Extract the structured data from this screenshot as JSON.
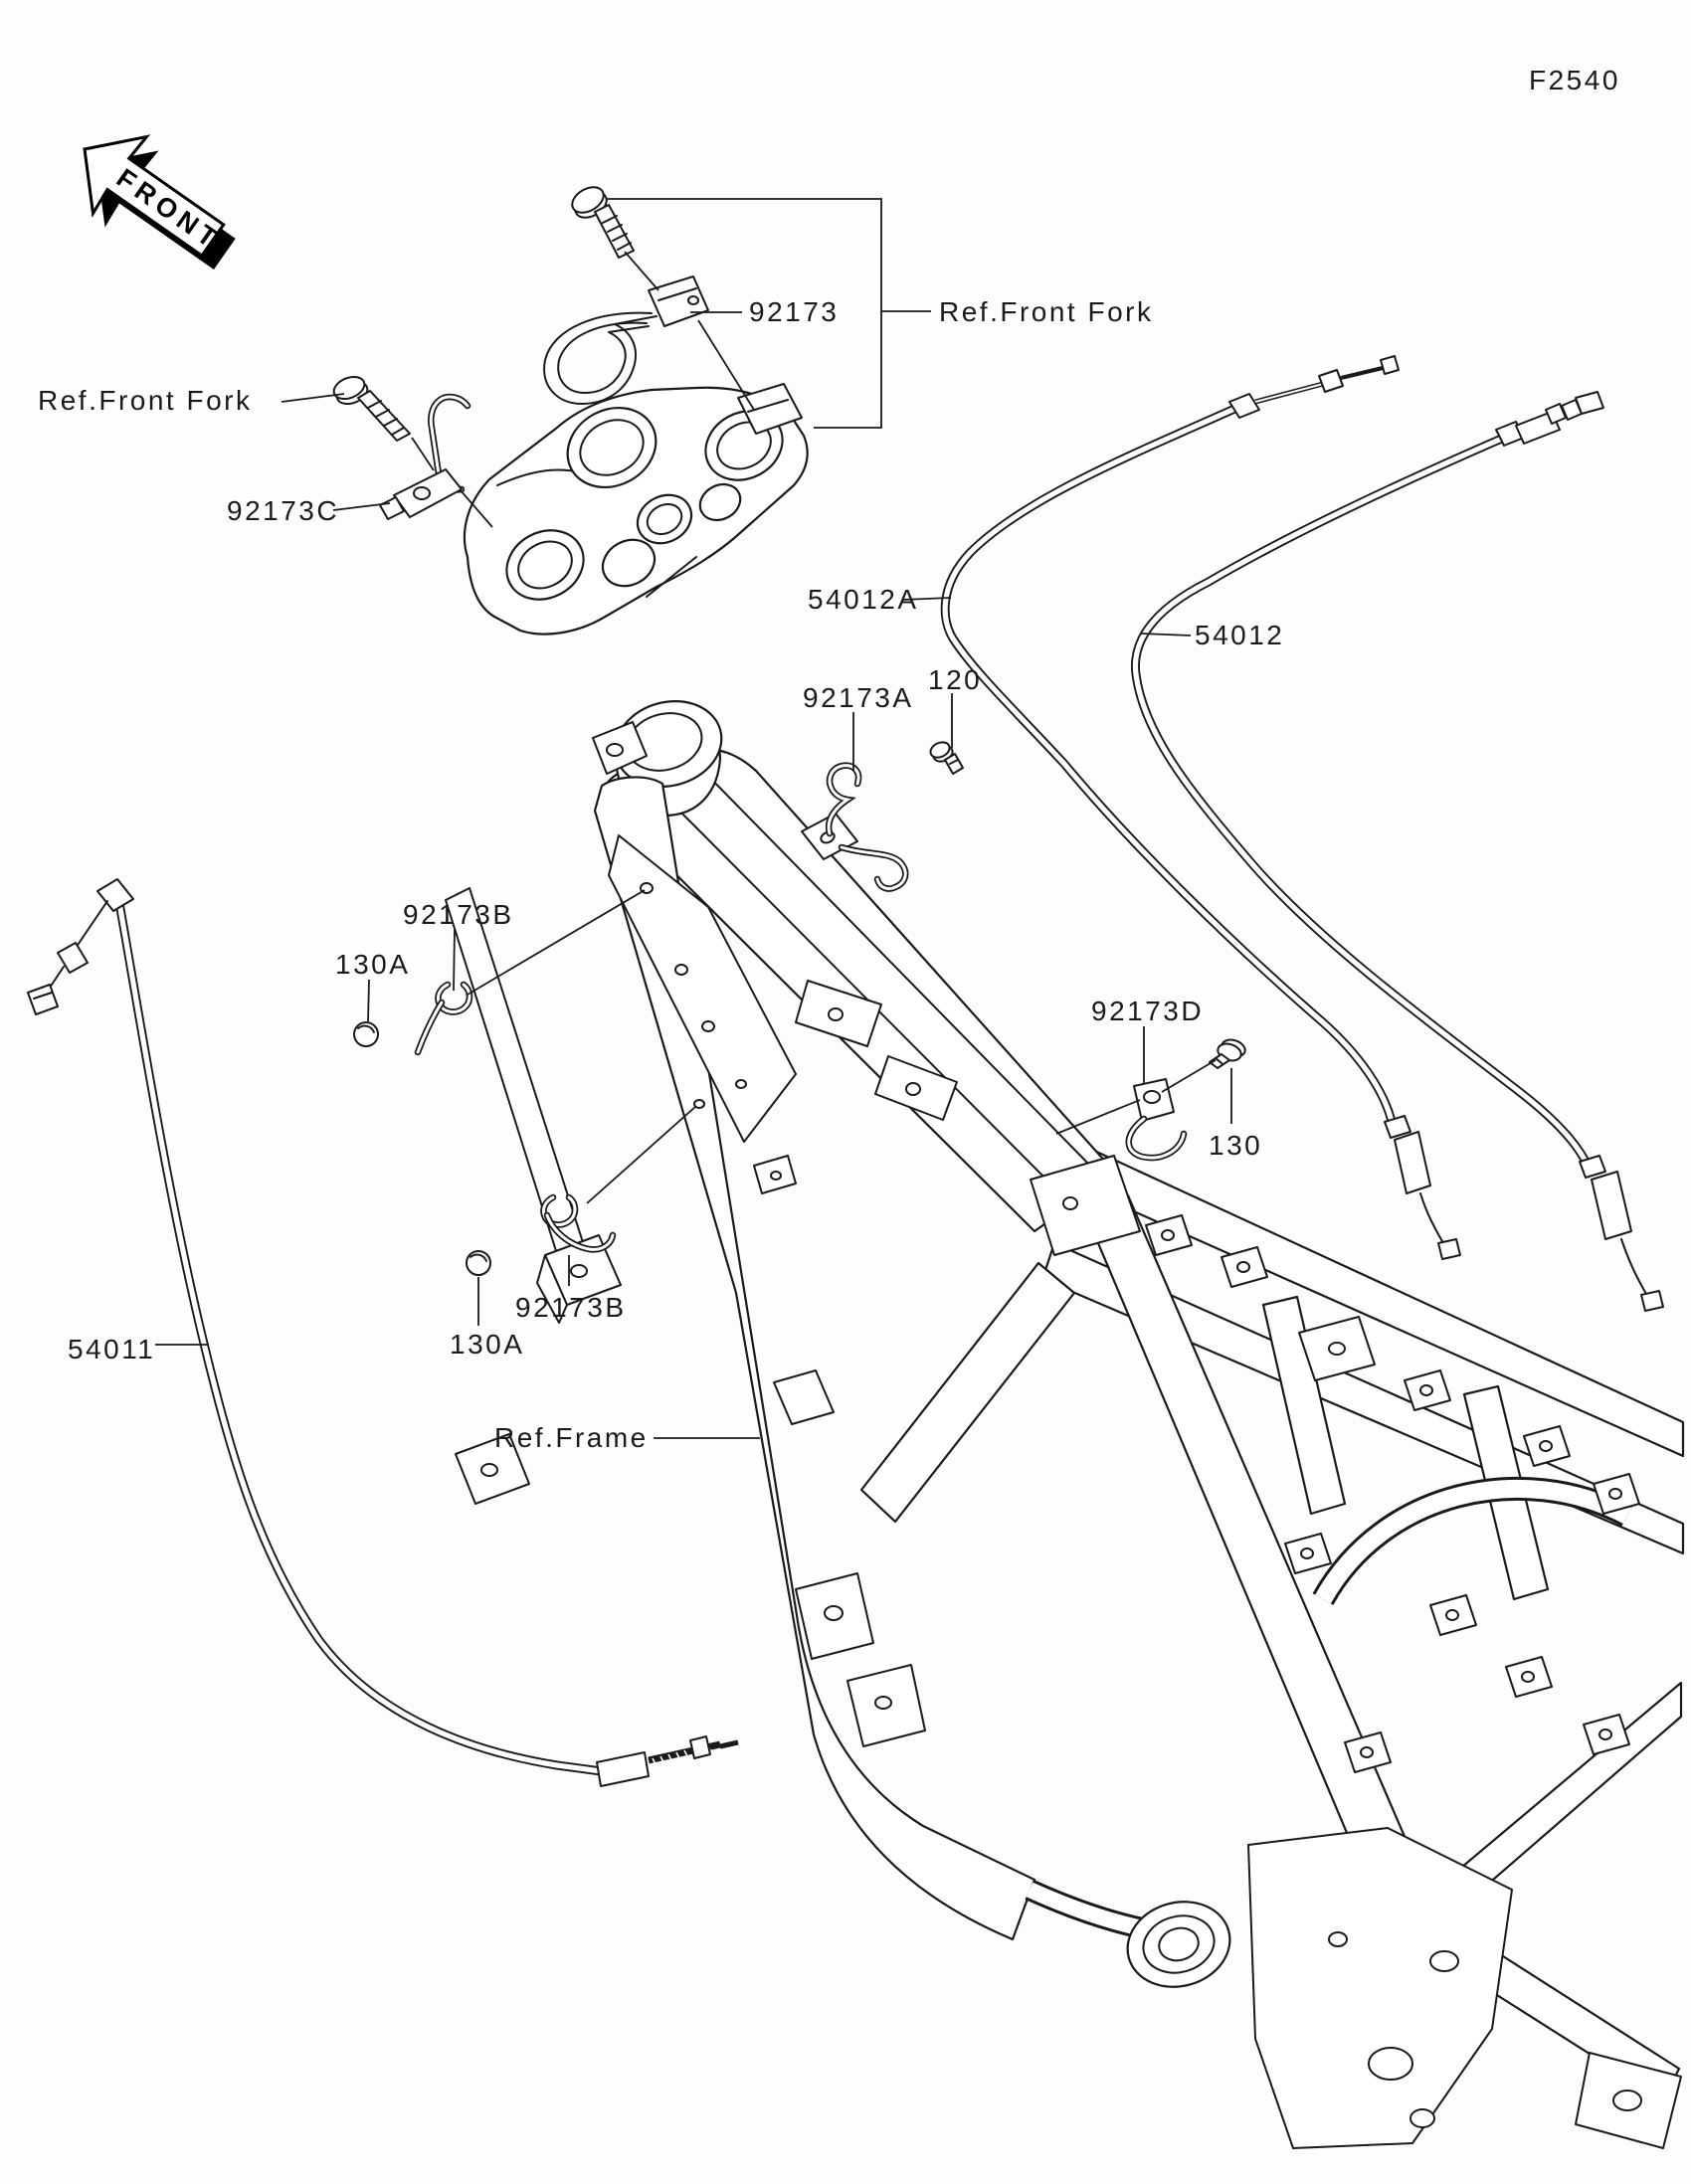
{
  "figure": {
    "code": "F2540"
  },
  "front_arrow": {
    "label": "FRONT"
  },
  "parts": {
    "92173": "92173",
    "92173A": "92173A",
    "92173B": "92173B",
    "92173C": "92173C",
    "92173D": "92173D",
    "54011": "54011",
    "54012": "54012",
    "54012A": "54012A",
    "120": "120",
    "130": "130",
    "130A": "130A"
  },
  "references": {
    "front_fork": "Ref.Front Fork",
    "frame": "Ref.Frame"
  },
  "colors": {
    "background": "#fcfdfc",
    "line": "#1a1a1a"
  }
}
